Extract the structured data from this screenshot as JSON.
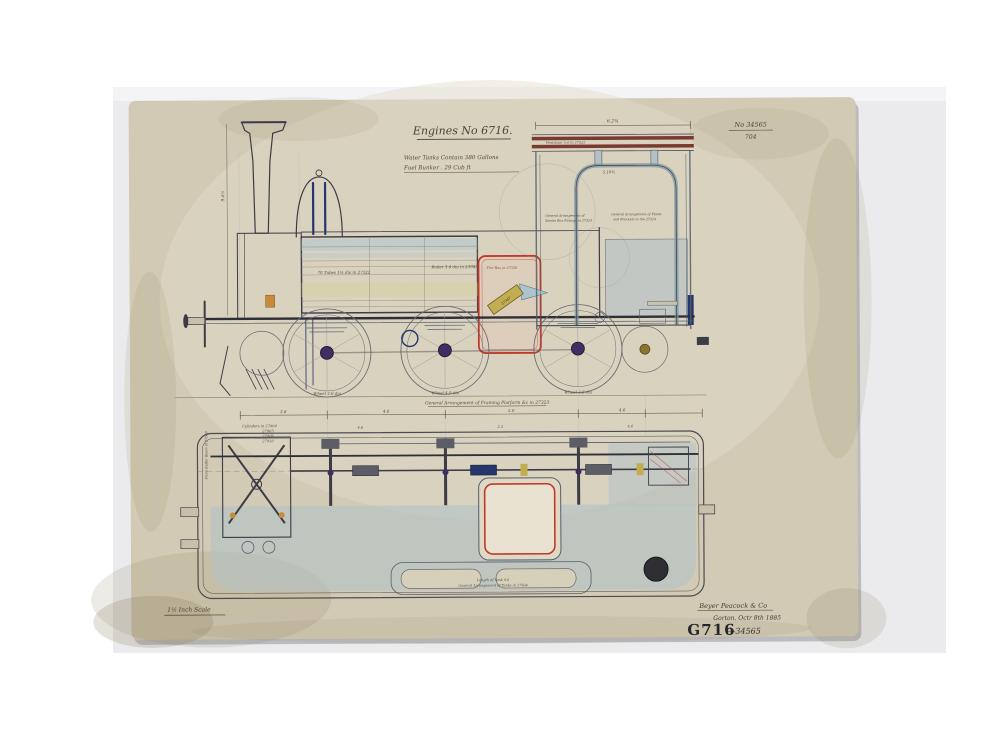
{
  "page": {
    "description": "Photograph of an aged engineering drawing of a tank locomotive, side elevation with rear end view above a plan view",
    "backdrop_color": "#ebebed",
    "paper_color": "#d2cab4"
  },
  "palette": {
    "ink": "#3c3c46",
    "red": "#bf3a2c",
    "wash_blue": "#aec6cf",
    "tank_blue": "#b3c1c7",
    "pale_yellow": "#d6cf9e",
    "maroon": "#7a3b2e",
    "navy": "#24366b",
    "purple": "#3f2d63",
    "olive_tag": "#c2ad52",
    "orange": "#c98a3a"
  },
  "title_block": {
    "title": "Engines No 6716.",
    "spec_line1": "Water Tanks Contain  380 Gallons",
    "spec_line2": "Fuel Bunker   .    29 Cub ft"
  },
  "drawing_ref": {
    "number": "No 34565",
    "folio": "704"
  },
  "elevation": {
    "chimney_dim": "9.4½",
    "boiler_note_left": "70 Tubes 1¾ dia in 27322",
    "boiler_note_right": "Boiler 3.6 dia in 23985",
    "firebox_note": "Fire Box in 27326",
    "tag_note": "27347",
    "wheel_labels": [
      "Wheel 3.6 dia",
      "Wheel 4.0 dia",
      "Wheel 3.6 dia"
    ],
    "framing_note": "General Arrangement of Framing Platform &c in 27323",
    "dims": [
      "3.8",
      "4.6",
      "5.0",
      "4.6"
    ],
    "cylinders_list": [
      "Cylinders in 27904",
      "27905",
      "27906",
      "27910"
    ]
  },
  "end_view": {
    "width_dim": "6.2¾",
    "inner_dim": "5.10½",
    "ventilator_note": "Ventilator 5.6 in 27522",
    "note_left_l1": "General Arrangement of",
    "note_left_l2": "Smoke Box Fittings in 27324",
    "note_right_l1": "General Arrangement of Plates",
    "note_right_l2": "and Brackets in the 27324"
  },
  "plan": {
    "tank_note1": "Length of Tank 9.6",
    "tank_note2": "General Arrangement of Tanks in 27564",
    "buffer_note": "Front Buffer Beam in 27560",
    "dims": [
      "4.6",
      "2.3",
      "4.6"
    ]
  },
  "footer": {
    "scale_note": "1½ Inch Scale",
    "maker": "Beyer Peacock & Co",
    "place_date": "Gorton. Octr 8th 1885",
    "stamp": "G716",
    "stamp_number": "—34565"
  }
}
